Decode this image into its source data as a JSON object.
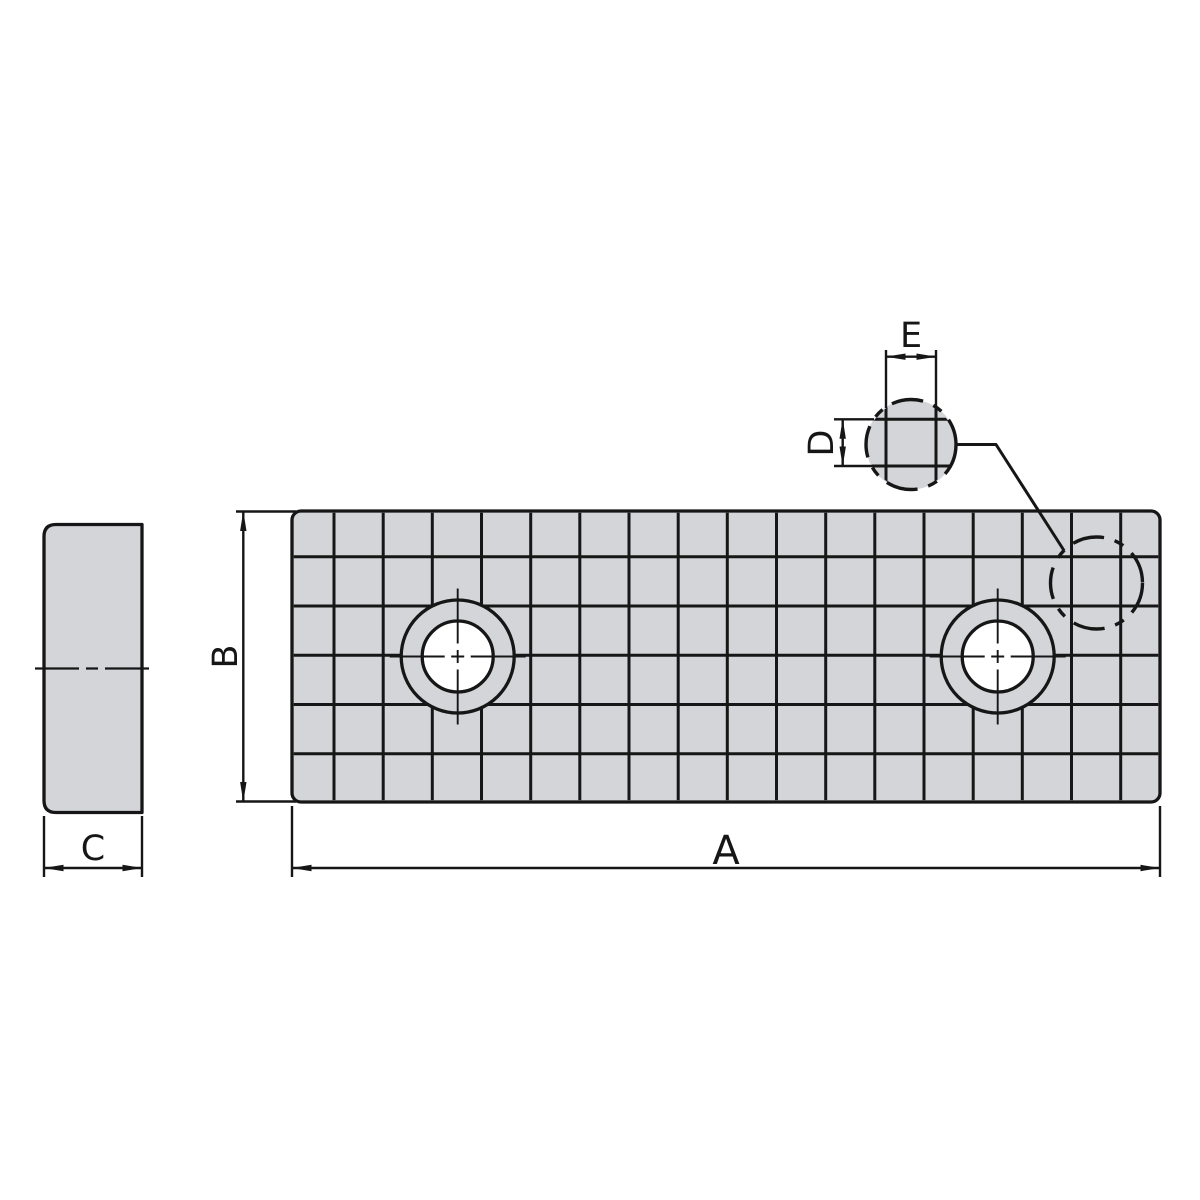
{
  "colors": {
    "background": "#ffffff",
    "part_fill": "#d3d5d8",
    "line_color": "#161616"
  },
  "views": {
    "side_view": {
      "thickness_dim_label": "C"
    },
    "front_view": {
      "length_dim_label": "A",
      "height_dim_label": "B",
      "grid_columns": 18,
      "grid_rows": 6,
      "hole_count": 2
    },
    "detail_view": {
      "groove_pitch_height_label": "D",
      "groove_pitch_width_label": "E"
    }
  }
}
